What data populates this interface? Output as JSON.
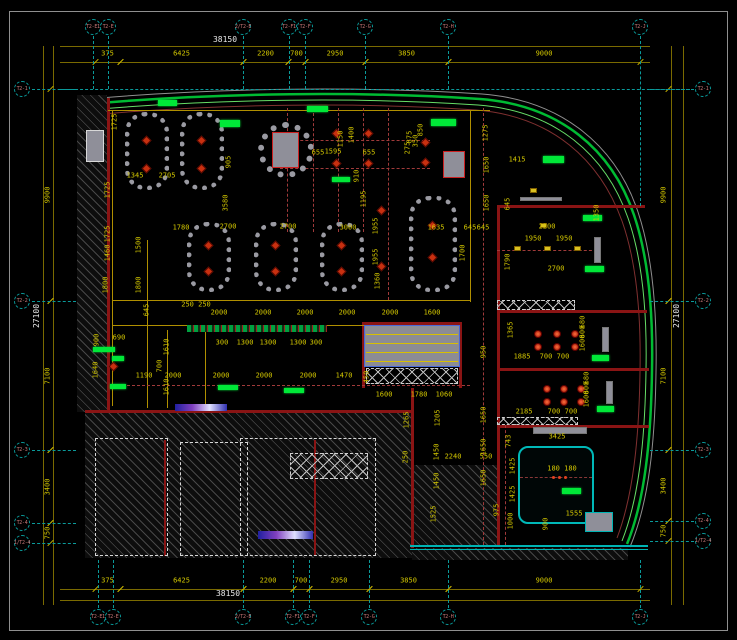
{
  "drawing_type": "CAD reflected ceiling / lighting floor plan",
  "colors": {
    "background": "#000000",
    "dim_text": "#d4c800",
    "dim_line": "#7a6a00",
    "grid_line": "#0a9a9a",
    "bubble_text": "#c87878",
    "wall_red": "#8a1414",
    "facade_green": "#00bb33",
    "highlight_green": "#00e838",
    "light_red": "#c83010",
    "booth_gray": "#9a9aa2",
    "white_dash": "#d8d8d8",
    "teal": "#00b4b4"
  },
  "grid": {
    "top_bubbles": [
      {
        "label": "T2-E1",
        "x": 93
      },
      {
        "label": "T2-E",
        "x": 108
      },
      {
        "label": "2/T2-E",
        "x": 243
      },
      {
        "label": "T2-F1",
        "x": 289
      },
      {
        "label": "T2-F",
        "x": 305
      },
      {
        "label": "T2-G",
        "x": 365
      },
      {
        "label": "T2-H",
        "x": 448
      },
      {
        "label": "T2-J",
        "x": 640
      }
    ],
    "bottom_bubbles": [
      {
        "label": "T2-E1",
        "x": 98
      },
      {
        "label": "T2-E",
        "x": 113
      },
      {
        "label": "2/T2-E",
        "x": 243
      },
      {
        "label": "T2-F1",
        "x": 293
      },
      {
        "label": "T2-F",
        "x": 309
      },
      {
        "label": "T2-G",
        "x": 369
      },
      {
        "label": "T2-H",
        "x": 448
      },
      {
        "label": "T2-J",
        "x": 640
      }
    ],
    "left_bubbles": [
      {
        "label": "T2-1",
        "y": 89
      },
      {
        "label": "T2-2",
        "y": 301
      },
      {
        "label": "T2-3",
        "y": 450
      },
      {
        "label": "T2-4",
        "y": 523
      },
      {
        "label": "1/T2-4",
        "y": 543
      }
    ],
    "right_bubbles": [
      {
        "label": "T2-1",
        "y": 89
      },
      {
        "label": "T2-2",
        "y": 301
      },
      {
        "label": "T2-3",
        "y": 450
      },
      {
        "label": "T2-4",
        "y": 521
      },
      {
        "label": "1/T2-4",
        "y": 541
      }
    ]
  },
  "dimensions": {
    "top": {
      "overall": "38150",
      "overall_x": 225,
      "segments": [
        [
          "375",
          95,
          120
        ],
        [
          "6425",
          120,
          243
        ],
        [
          "2200",
          243,
          288
        ],
        [
          "700",
          288,
          305
        ],
        [
          "2950",
          305,
          365
        ],
        [
          "3850",
          365,
          448
        ],
        [
          "9000",
          448,
          640
        ]
      ]
    },
    "bottom": {
      "overall": "38150",
      "overall_x": 228,
      "segments": [
        [
          "375",
          95,
          120
        ],
        [
          "6425",
          120,
          243
        ],
        [
          "2200",
          243,
          293
        ],
        [
          "700",
          293,
          309
        ],
        [
          "2950",
          309,
          369
        ],
        [
          "3850",
          369,
          448
        ],
        [
          "9000",
          448,
          640
        ]
      ]
    },
    "left": {
      "overall": "27100",
      "segments": [
        [
          "9900",
          89,
          301
        ],
        [
          "7100",
          301,
          450
        ],
        [
          "3400",
          450,
          523
        ],
        [
          "750",
          523,
          543
        ]
      ]
    },
    "right": {
      "overall": "27100",
      "segments": [
        [
          "9900",
          89,
          301
        ],
        [
          "7100",
          301,
          450
        ],
        [
          "3400",
          450,
          521
        ],
        [
          "750",
          521,
          541
        ]
      ]
    }
  },
  "interior_dims": [
    [
      "1725",
      115,
      122,
      1
    ],
    [
      "905",
      229,
      162,
      1
    ],
    [
      "1345",
      135,
      176,
      0
    ],
    [
      "2705",
      167,
      176,
      0
    ],
    [
      "655",
      318,
      153,
      0
    ],
    [
      "1595",
      333,
      152,
      0
    ],
    [
      "655",
      369,
      153,
      0
    ],
    [
      "1400",
      352,
      135,
      1
    ],
    [
      "1150",
      341,
      139,
      1
    ],
    [
      "910",
      357,
      176,
      1
    ],
    [
      "1195",
      364,
      199,
      1
    ],
    [
      "350",
      416,
      141,
      1
    ],
    [
      "275",
      408,
      148,
      1
    ],
    [
      "850",
      421,
      130,
      1
    ],
    [
      "875",
      410,
      137,
      1
    ],
    [
      "1275",
      486,
      133,
      1
    ],
    [
      "1650",
      487,
      165,
      1
    ],
    [
      "1650",
      487,
      203,
      1
    ],
    [
      "1725",
      108,
      190,
      1
    ],
    [
      "1725",
      108,
      234,
      1
    ],
    [
      "3580",
      226,
      203,
      1
    ],
    [
      "1780",
      181,
      228,
      0
    ],
    [
      "2700",
      228,
      227,
      0
    ],
    [
      "2700",
      288,
      227,
      0
    ],
    [
      "3000",
      348,
      228,
      0
    ],
    [
      "1955",
      376,
      226,
      1
    ],
    [
      "1955",
      376,
      257,
      1
    ],
    [
      "1360",
      378,
      281,
      1
    ],
    [
      "1635",
      436,
      228,
      0
    ],
    [
      "645",
      470,
      228,
      0
    ],
    [
      "645",
      483,
      228,
      0
    ],
    [
      "1700",
      463,
      253,
      1
    ],
    [
      "1415",
      517,
      160,
      0
    ],
    [
      "645",
      508,
      204,
      1
    ],
    [
      "1790",
      508,
      262,
      1
    ],
    [
      "1365",
      511,
      330,
      1
    ],
    [
      "2200",
      547,
      227,
      0
    ],
    [
      "1950",
      533,
      239,
      0
    ],
    [
      "1950",
      564,
      239,
      0
    ],
    [
      "2700",
      556,
      269,
      0
    ],
    [
      "1350",
      597,
      213,
      1
    ],
    [
      "2000",
      219,
      313,
      0
    ],
    [
      "2000",
      263,
      313,
      0
    ],
    [
      "2000",
      305,
      313,
      0
    ],
    [
      "2000",
      347,
      313,
      0
    ],
    [
      "2000",
      390,
      313,
      0
    ],
    [
      "1600",
      432,
      313,
      0
    ],
    [
      "250 250",
      196,
      305,
      0
    ],
    [
      "300",
      222,
      343,
      0
    ],
    [
      "1300",
      245,
      343,
      0
    ],
    [
      "1300",
      268,
      343,
      0
    ],
    [
      "1300",
      298,
      343,
      0
    ],
    [
      "300",
      316,
      343,
      0
    ],
    [
      "1190",
      144,
      376,
      0
    ],
    [
      "2000",
      173,
      376,
      0
    ],
    [
      "2000",
      221,
      376,
      0
    ],
    [
      "2000",
      264,
      376,
      0
    ],
    [
      "2000",
      308,
      376,
      0
    ],
    [
      "1470",
      344,
      376,
      0
    ],
    [
      "450",
      367,
      377,
      1
    ],
    [
      "1460",
      108,
      253,
      1
    ],
    [
      "1500",
      139,
      245,
      1
    ],
    [
      "1800",
      106,
      285,
      1
    ],
    [
      "1800",
      139,
      285,
      1
    ],
    [
      "645",
      147,
      310,
      1
    ],
    [
      "690",
      119,
      338,
      0
    ],
    [
      "900",
      97,
      340,
      1
    ],
    [
      "1640",
      96,
      370,
      1
    ],
    [
      "1610",
      167,
      347,
      1
    ],
    [
      "700",
      160,
      366,
      1
    ],
    [
      "1610",
      167,
      387,
      1
    ],
    [
      "1600",
      384,
      395,
      0
    ],
    [
      "1780",
      419,
      395,
      0
    ],
    [
      "1060",
      444,
      395,
      0
    ],
    [
      "1265",
      407,
      420,
      1
    ],
    [
      "950",
      484,
      352,
      1
    ],
    [
      "1885",
      522,
      357,
      0
    ],
    [
      "700",
      546,
      357,
      0
    ],
    [
      "700",
      563,
      357,
      0
    ],
    [
      "680",
      583,
      322,
      1
    ],
    [
      "600",
      583,
      332,
      1
    ],
    [
      "1600",
      583,
      343,
      1
    ],
    [
      "2185",
      524,
      412,
      0
    ],
    [
      "700",
      554,
      412,
      0
    ],
    [
      "700",
      571,
      412,
      0
    ],
    [
      "680",
      587,
      378,
      1
    ],
    [
      "600",
      587,
      388,
      1
    ],
    [
      "1600",
      587,
      399,
      1
    ],
    [
      "3425",
      557,
      437,
      0
    ],
    [
      "743",
      509,
      441,
      1
    ],
    [
      "1425",
      513,
      466,
      1
    ],
    [
      "1425",
      513,
      494,
      1
    ],
    [
      "1000",
      511,
      521,
      1
    ],
    [
      "900",
      546,
      524,
      1
    ],
    [
      "180 180",
      562,
      469,
      0
    ],
    [
      "1555",
      574,
      514,
      0
    ],
    [
      "250",
      406,
      457,
      1
    ],
    [
      "2240",
      453,
      457,
      0
    ],
    [
      "550",
      486,
      457,
      0
    ],
    [
      "1650",
      484,
      415,
      1
    ],
    [
      "1650",
      484,
      447,
      1
    ],
    [
      "1650",
      484,
      478,
      1
    ],
    [
      "975",
      497,
      510,
      1
    ],
    [
      "1205",
      438,
      418,
      1
    ],
    [
      "1450",
      437,
      452,
      1
    ],
    [
      "1450",
      437,
      481,
      1
    ],
    [
      "1525",
      434,
      514,
      1
    ]
  ],
  "symbols": {
    "diamond_lights": [
      [
        146,
        140
      ],
      [
        146,
        168
      ],
      [
        201,
        140
      ],
      [
        201,
        168
      ],
      [
        208,
        245
      ],
      [
        208,
        271
      ],
      [
        275,
        245
      ],
      [
        275,
        271
      ],
      [
        341,
        245
      ],
      [
        341,
        271
      ],
      [
        432,
        225
      ],
      [
        432,
        257
      ],
      [
        336,
        133
      ],
      [
        368,
        133
      ],
      [
        336,
        163
      ],
      [
        368,
        163
      ],
      [
        425,
        142
      ],
      [
        425,
        162
      ],
      [
        381,
        210
      ],
      [
        381,
        266
      ],
      [
        113,
        366
      ]
    ],
    "spot_lights": [
      [
        538,
        334
      ],
      [
        557,
        334
      ],
      [
        575,
        334
      ],
      [
        538,
        347
      ],
      [
        557,
        347
      ],
      [
        575,
        347
      ],
      [
        547,
        389
      ],
      [
        564,
        389
      ],
      [
        581,
        389
      ],
      [
        547,
        402
      ],
      [
        564,
        402
      ],
      [
        581,
        402
      ]
    ],
    "small_dots": [
      [
        553,
        477
      ],
      [
        559,
        477
      ],
      [
        565,
        477
      ]
    ],
    "wall_lights": [
      [
        517,
        248
      ],
      [
        547,
        248
      ],
      [
        577,
        248
      ],
      [
        533,
        190
      ],
      [
        543,
        225
      ]
    ],
    "green_highlights": [
      [
        158,
        100,
        19,
        6
      ],
      [
        220,
        120,
        20,
        7
      ],
      [
        307,
        106,
        21,
        6
      ],
      [
        332,
        177,
        18,
        5
      ],
      [
        431,
        119,
        25,
        7
      ],
      [
        543,
        156,
        21,
        7
      ],
      [
        583,
        215,
        19,
        6
      ],
      [
        585,
        266,
        19,
        6
      ],
      [
        592,
        355,
        17,
        6
      ],
      [
        597,
        406,
        17,
        6
      ],
      [
        562,
        488,
        19,
        6
      ],
      [
        93,
        347,
        22,
        5
      ],
      [
        112,
        356,
        12,
        5
      ],
      [
        110,
        384,
        16,
        5
      ],
      [
        218,
        385,
        20,
        5
      ],
      [
        284,
        388,
        20,
        5
      ]
    ]
  },
  "furniture": {
    "booths": [
      [
        125,
        112,
        44,
        78
      ],
      [
        180,
        112,
        44,
        78
      ],
      [
        187,
        222,
        44,
        70
      ],
      [
        254,
        222,
        44,
        70
      ],
      [
        320,
        222,
        44,
        70
      ],
      [
        409,
        196,
        48,
        96
      ]
    ],
    "circle": [
      258,
      122,
      56
    ],
    "columns": [
      [
        86,
        130,
        18,
        32,
        "#d8d8d8"
      ],
      [
        443,
        151,
        22,
        27,
        "#cc2020"
      ],
      [
        272,
        132,
        27,
        36,
        "#cc2020"
      ],
      [
        594,
        237,
        7,
        26,
        "#777777"
      ],
      [
        602,
        327,
        7,
        25,
        "#777777"
      ],
      [
        606,
        381,
        7,
        23,
        "#777777"
      ],
      [
        533,
        427,
        54,
        7,
        "#777777"
      ],
      [
        520,
        197,
        42,
        4,
        "#777777"
      ],
      [
        585,
        512,
        28,
        20,
        "#00b4b4"
      ]
    ]
  },
  "regions": {
    "hatches": [
      [
        77,
        95,
        30,
        317
      ],
      [
        85,
        412,
        327,
        146
      ],
      [
        412,
        465,
        85,
        80
      ],
      [
        412,
        548,
        216,
        12
      ]
    ],
    "walls": [
      [
        107,
        98,
        3,
        314
      ],
      [
        85,
        410,
        328,
        3
      ],
      [
        497,
        205,
        148,
        3
      ],
      [
        497,
        310,
        150,
        3
      ],
      [
        497,
        368,
        152,
        3
      ],
      [
        497,
        425,
        152,
        3
      ],
      [
        497,
        205,
        3,
        342
      ],
      [
        411,
        388,
        3,
        160
      ],
      [
        362,
        322,
        100,
        3
      ],
      [
        362,
        322,
        3,
        66
      ],
      [
        459,
        322,
        3,
        66
      ],
      [
        164,
        440,
        2,
        116
      ],
      [
        314,
        440,
        2,
        116
      ]
    ],
    "teal_walls": [
      [
        410,
        545,
        238,
        2
      ],
      [
        410,
        549,
        238,
        1
      ]
    ],
    "yellow_lines": [
      [
        108,
        110,
        382,
        1
      ],
      [
        112,
        110,
        1,
        296
      ],
      [
        112,
        300,
        358,
        1
      ],
      [
        112,
        325,
        268,
        1
      ],
      [
        470,
        110,
        1,
        192
      ],
      [
        147,
        240,
        1,
        168
      ],
      [
        167,
        330,
        1,
        78
      ],
      [
        205,
        330,
        1,
        78
      ]
    ],
    "red_dashed_h": [
      [
        280,
        140,
        150
      ],
      [
        280,
        168,
        150
      ],
      [
        497,
        250,
        100
      ],
      [
        520,
        477,
        72
      ],
      [
        112,
        385,
        358
      ]
    ],
    "red_dashed_v": [
      [
        287,
        108,
        124
      ],
      [
        313,
        108,
        124
      ],
      [
        338,
        108,
        124
      ],
      [
        363,
        108,
        124
      ],
      [
        388,
        108,
        192
      ],
      [
        483,
        108,
        437
      ],
      [
        505,
        425,
        120
      ]
    ],
    "white_dashed_rooms": [
      [
        95,
        438,
        73,
        118
      ],
      [
        180,
        442,
        68,
        114
      ],
      [
        240,
        438,
        136,
        118
      ]
    ],
    "xboxes": [
      [
        290,
        453,
        78,
        26
      ],
      [
        366,
        368,
        92,
        16
      ],
      [
        497,
        300,
        78,
        10
      ],
      [
        497,
        417,
        81,
        8
      ]
    ],
    "louver": {
      "x": 364,
      "y": 325,
      "w": 96,
      "h": 42,
      "lines_y": [
        334,
        343,
        352,
        361
      ]
    },
    "counter": [
      187,
      325,
      140,
      7
    ],
    "glass_strips": [
      [
        175,
        404,
        52,
        7
      ],
      [
        258,
        531,
        55,
        8
      ]
    ],
    "teal_room": [
      518,
      446,
      76,
      78
    ]
  }
}
